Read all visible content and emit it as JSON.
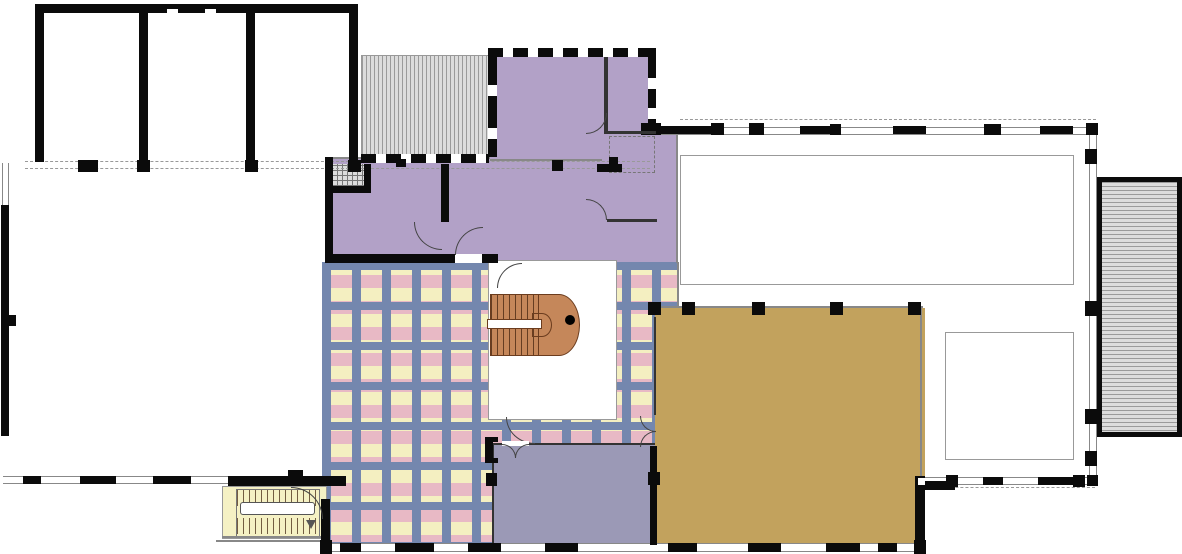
{
  "document": {
    "kind": "architectural-floor-plan",
    "page_background": "#ffffff"
  },
  "colors": {
    "wall": "#0b0b0b",
    "line": "#888888",
    "dark": "#333333",
    "dash": "#999999",
    "mauve": "#b2a1c7",
    "plaidYellow": "#f4efc1",
    "plaidPink": "#e8b9c5",
    "plaidBlue": "#7487ae",
    "gold": "#c2a25d",
    "slate": "#9b99b6",
    "paleYellow": "#f5f1c4",
    "stair": "#c5875a",
    "stairDark": "#6b3c1e",
    "hatchFill": "#dcdcdc",
    "hatchLine": "#9a9a9a",
    "white": "#ffffff"
  },
  "areas": {
    "lavender_room_west": {
      "fill": "#b2a1c7"
    },
    "lavender_room_main": {
      "fill": "#b2a1c7"
    },
    "lavender_strip": {
      "fill": "#b2a1c7"
    },
    "plaid_hall": {
      "fill": "#f4efc1"
    },
    "gold_hall": {
      "fill": "#c2a25d"
    },
    "slate_room": {
      "fill": "#9b99b6"
    },
    "sw_stair_room": {
      "fill": "#f5f1c4"
    },
    "stair_void": {
      "fill": "#ffffff"
    },
    "north_deck": {
      "fill": "#dcdcdc"
    },
    "east_deck": {
      "fill": "#dcdcdc"
    }
  }
}
